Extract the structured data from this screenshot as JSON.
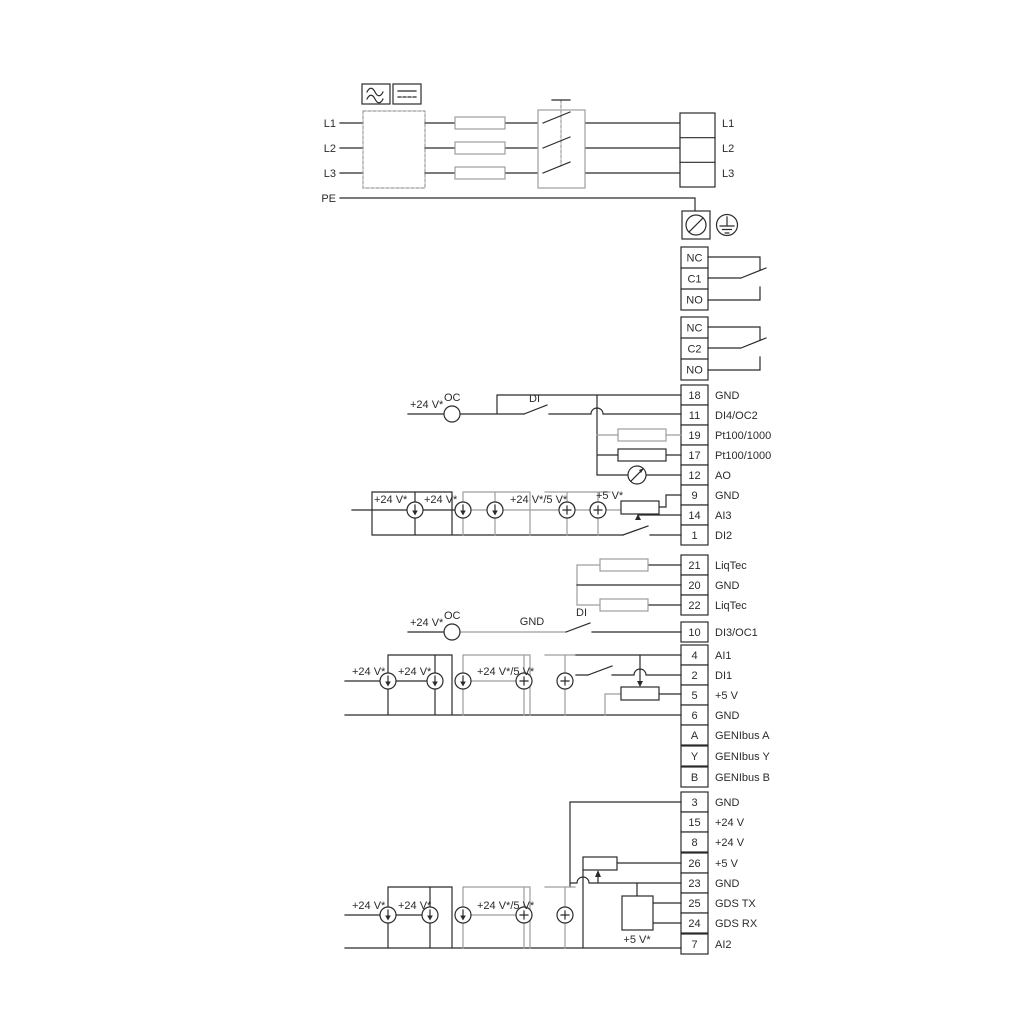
{
  "power": {
    "input_labels": [
      "L1",
      "L2",
      "L3"
    ],
    "pe_label": "PE",
    "output_labels": [
      "L1",
      "L2",
      "L3"
    ]
  },
  "relays": {
    "relay1": [
      "NC",
      "C1",
      "NO"
    ],
    "relay2": [
      "NC",
      "C2",
      "NO"
    ]
  },
  "terminal_blocks": {
    "block1": {
      "rows": [
        {
          "num": "18",
          "label": "GND"
        },
        {
          "num": "11",
          "label": "DI4/OC2"
        },
        {
          "num": "19",
          "label": "Pt100/1000"
        },
        {
          "num": "17",
          "label": "Pt100/1000"
        },
        {
          "num": "12",
          "label": "AO"
        },
        {
          "num": "9",
          "label": "GND"
        },
        {
          "num": "14",
          "label": "AI3"
        },
        {
          "num": "1",
          "label": "DI2"
        }
      ]
    },
    "liqtec": {
      "rows": [
        {
          "num": "21",
          "label": "LiqTec"
        },
        {
          "num": "20",
          "label": "GND"
        },
        {
          "num": "22",
          "label": "LiqTec"
        }
      ]
    },
    "block2": {
      "rows": [
        {
          "num": "10",
          "label": "DI3/OC1"
        },
        {
          "num": "4",
          "label": "AI1"
        },
        {
          "num": "2",
          "label": "DI1"
        },
        {
          "num": "5",
          "label": "+5 V"
        },
        {
          "num": "6",
          "label": "GND"
        },
        {
          "num": "A",
          "label": "GENIbus A"
        },
        {
          "num": "Y",
          "label": "GENIbus Y"
        },
        {
          "num": "B",
          "label": "GENIbus B"
        }
      ]
    },
    "block3": {
      "rows": [
        {
          "num": "3",
          "label": "GND"
        },
        {
          "num": "15",
          "label": "+24 V"
        },
        {
          "num": "8",
          "label": "+24 V"
        },
        {
          "num": "26",
          "label": "+5 V"
        },
        {
          "num": "23",
          "label": "GND"
        },
        {
          "num": "25",
          "label": "GDS TX"
        },
        {
          "num": "24",
          "label": "GDS RX"
        },
        {
          "num": "7",
          "label": "AI2"
        }
      ]
    }
  },
  "annotations": {
    "di4": {
      "supply": "+24 V*",
      "oc": "OC",
      "di": "DI"
    },
    "ai3": {
      "supply1": "+24 V*",
      "supply2": "+24 V*",
      "supply3": "+24 V*/5 V*",
      "supply4": "+5 V*"
    },
    "di3": {
      "supply": "+24 V*",
      "oc": "OC",
      "gnd": "GND",
      "di": "DI"
    },
    "ai1": {
      "supply1": "+24 V*",
      "supply2": "+24 V*",
      "supply3": "+24 V*/5 V*"
    },
    "ai2": {
      "supply1": "+24 V*",
      "supply2": "+24 V*",
      "supply3": "+24 V*/5 V*",
      "supply4": "+5 V*"
    }
  },
  "icons": {
    "ac": "ac-waveform-icon",
    "dc": "dc-symbol-icon",
    "screw": "screw-terminal-icon",
    "earth": "earth-ground-icon"
  },
  "colors": {
    "wire": "#2b2b2b",
    "wire_gray": "#9e9e9e",
    "background": "#ffffff"
  }
}
